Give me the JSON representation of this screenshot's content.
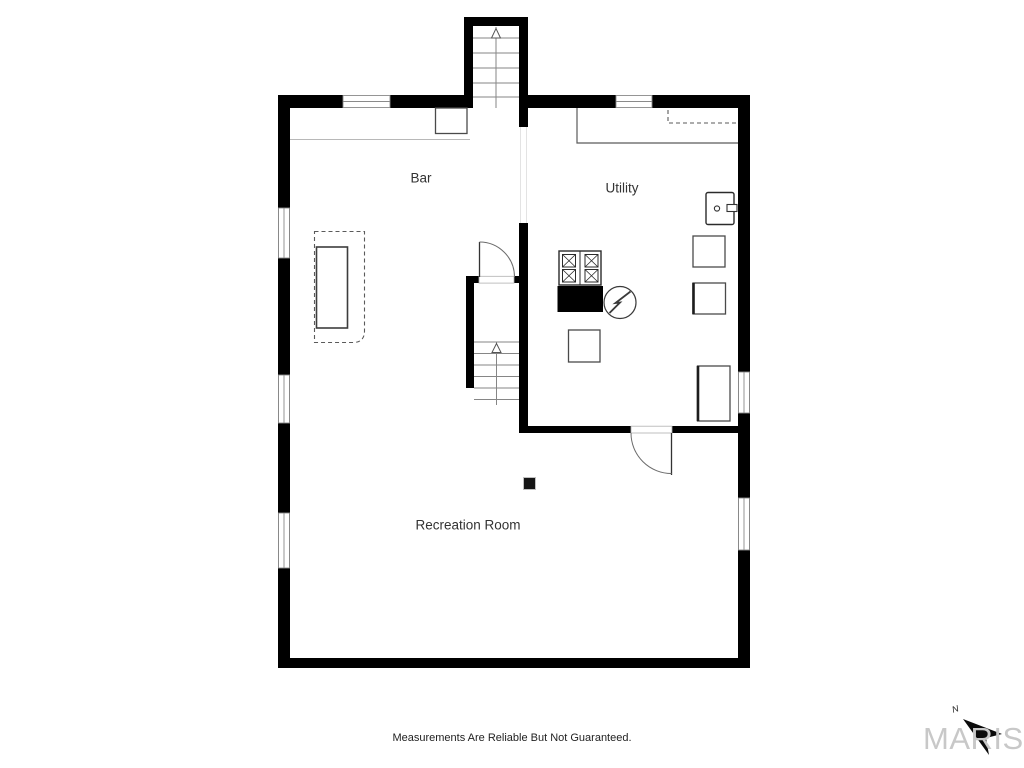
{
  "theme": {
    "bg": "#ffffff",
    "wall": "#000000",
    "label": "#333333",
    "logo": "#c8c8c8"
  },
  "floor_plan": {
    "type": "basement-floor-plan",
    "rooms": [
      {
        "label": "Bar"
      },
      {
        "label": "Utility"
      },
      {
        "label": "Recreation Room"
      }
    ],
    "labels": {
      "bar": "Bar",
      "utility": "Utility",
      "recreation_room": "Recreation Room"
    },
    "features": [
      "exterior staircase up (top bump-out)",
      "interior staircase",
      "bar island (dashed overhang with solid counter)",
      "bar back counter with cabinet",
      "utility counter with dashed upper cabinet",
      "laundry sink on right wall",
      "stove/furnace with black base",
      "electrical (circle with lightning bolt)",
      "floor squares / equipment pads",
      "two swing doors",
      "seven windows",
      "support post in recreation room"
    ]
  },
  "footer": {
    "disclaimer": "Measurements Are Reliable But Not Guaranteed."
  },
  "branding": {
    "logo_text": "MARIS",
    "north_label": "N"
  }
}
